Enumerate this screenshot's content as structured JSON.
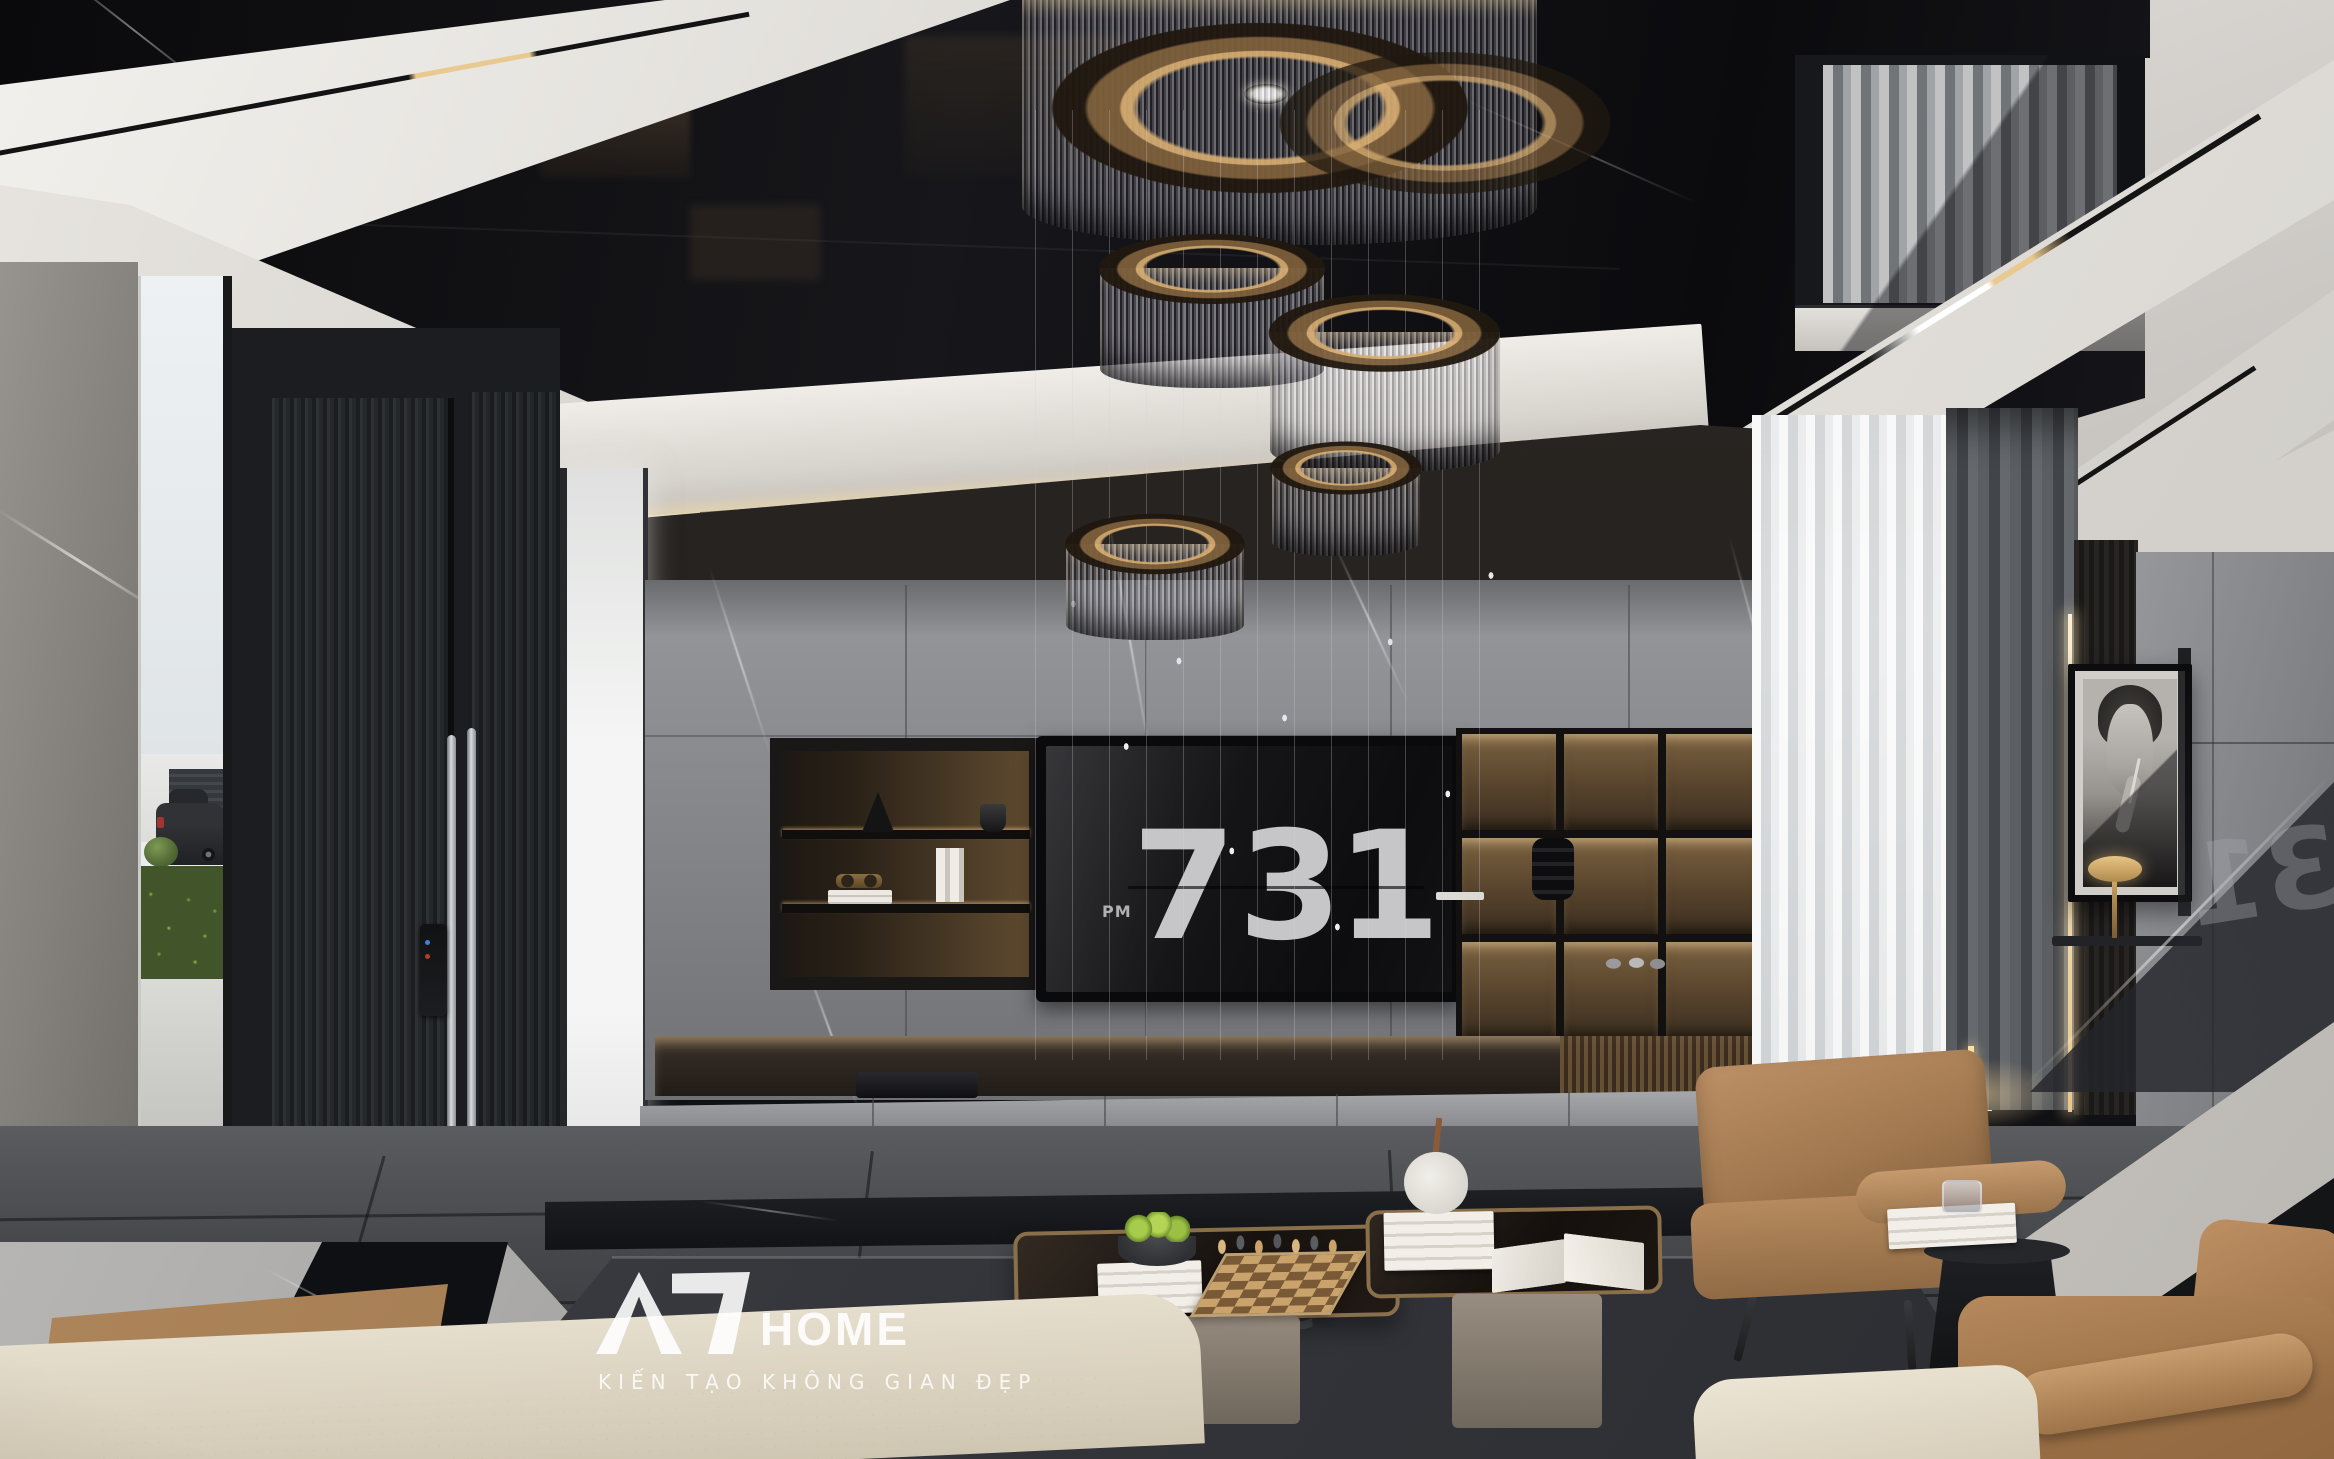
{
  "tv": {
    "clock": {
      "hour": "7",
      "minutes": "31",
      "meridiem": "PM"
    }
  },
  "reflections": {
    "stair_glass_minutes": "31",
    "table_top_minutes": "31"
  },
  "watermark": {
    "logo_mark": "AD",
    "logo_text": "HOME",
    "tagline": "KIẾN TẠO KHÔNG GIAN ĐẸP"
  },
  "palette": {
    "ceiling_gloss_black": "#0d0d10",
    "fascia_white": "#e9e6e1",
    "cove_warm_light": "#f4dda8",
    "bronze_metal": "#a07a4e",
    "marble_gray": "#8e9094",
    "wood_dark_brown": "#262220",
    "leather_tan": "#a87c57",
    "sofa_cream": "#ded6c5",
    "rug_charcoal": "#3a3c3f",
    "hedge_green": "#56702f",
    "apple_green": "#9dc43c",
    "tv_screen_black": "#141416",
    "clock_digits_gray": "#c6c6c9"
  }
}
